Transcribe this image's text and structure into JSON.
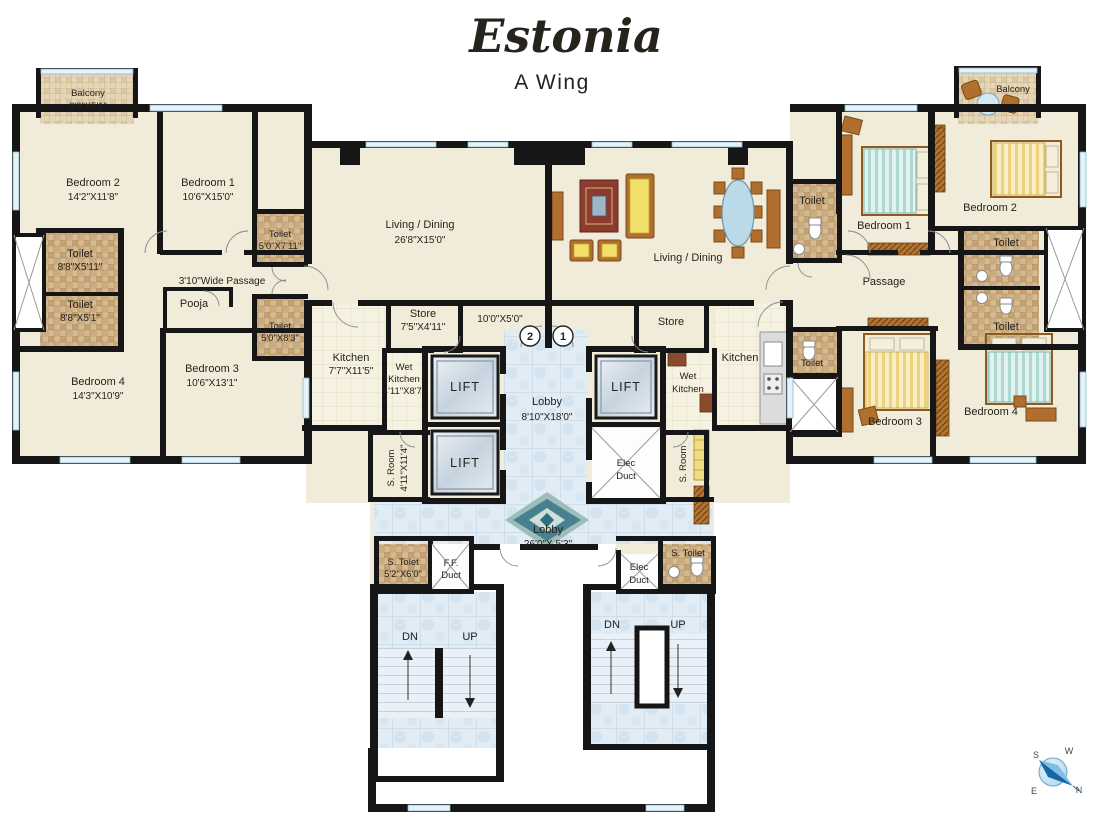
{
  "title": {
    "name": "Estonia",
    "wing": "A Wing"
  },
  "left": {
    "balcony": {
      "name": "Balcony",
      "dims": "8'3\"X5'1\""
    },
    "bedroom2": {
      "name": "Bedroom 2",
      "dims": "14'2\"X11'8\""
    },
    "bedroom1": {
      "name": "Bedroom 1",
      "dims": "10'6\"X15'0\""
    },
    "toilet_a": {
      "name": "Toilet",
      "dims": "8'8\"X5'11\""
    },
    "toilet_b": {
      "name": "Toilet",
      "dims": "8'8\"X5'1\""
    },
    "toilet_c": {
      "name": "Toilet",
      "dims": "5'0\"X7'11\""
    },
    "toilet_d": {
      "name": "Toilet",
      "dims": "5'0\"X8'3\""
    },
    "wide_passage": "3'10\"Wide Passage",
    "pooja": "Pooja",
    "bedroom3": {
      "name": "Bedroom 3",
      "dims": "10'6\"X13'1\""
    },
    "bedroom4": {
      "name": "Bedroom 4",
      "dims": "14'3\"X10'9\""
    },
    "living": {
      "name": "Living / Dining",
      "dims": "26'8\"X15'0\""
    },
    "store": {
      "name": "Store",
      "dims": "7'5\"X4'11\""
    },
    "inner_passage": "10'0\"X5'0\"",
    "kitchen": {
      "name": "Kitchen",
      "dims": "7'7\"X11'5\""
    },
    "wet_kitchen": {
      "line1": "Wet",
      "line2": "Kitchen",
      "dims": "4'11\"X8'7\""
    },
    "s_room": {
      "name": "S. Room",
      "dims": "4'11\"X11'4\""
    },
    "s_toilet": {
      "name": "S. Tolet",
      "dims": "5'2\"X6'0\""
    },
    "ff_duct": {
      "line1": "F.F.",
      "line2": "Duct"
    }
  },
  "core": {
    "lift": "LIFT",
    "lobby_upper": {
      "name": "Lobby",
      "dims": "8'10\"X18'0\""
    },
    "lobby_lower": {
      "name": "Lobby",
      "dims": "26'0\"X 5'3\""
    },
    "elec_duct": {
      "line1": "Elec",
      "line2": "Duct"
    },
    "flat2": "2",
    "flat1": "1",
    "dn": "DN",
    "up": "UP"
  },
  "right": {
    "living": "Living / Dining",
    "store": "Store",
    "kitchen": "Kitchen",
    "wet_kitchen": {
      "line1": "Wet",
      "line2": "Kitchen"
    },
    "toilet_entry": "Toilet",
    "toilet_passage": "Toilet",
    "s_room": "S. Room",
    "s_toilet": "S. Toilet",
    "elec_duct": {
      "line1": "Elec",
      "line2": "Duct"
    },
    "bedroom1": "Bedroom 1",
    "bedroom2": "Bedroom 2",
    "bedroom3": "Bedroom 3",
    "bedroom4": "Bedroom 4",
    "passage": "Passage",
    "balcony": "Balcony",
    "toilet_r1": "Toilet",
    "toilet_r2": "Toilet"
  },
  "compass": {
    "n": "N",
    "s": "S",
    "e": "E",
    "w": "W"
  },
  "colors": {
    "title": "#8d2f3d",
    "wall": "#161616",
    "floor": "#f1ecd9",
    "lobby_tile": "#dfeaf3",
    "toilet_tile": "#d5bb93",
    "wood": "#b06f2e",
    "stair": "#e9f0f7"
  }
}
